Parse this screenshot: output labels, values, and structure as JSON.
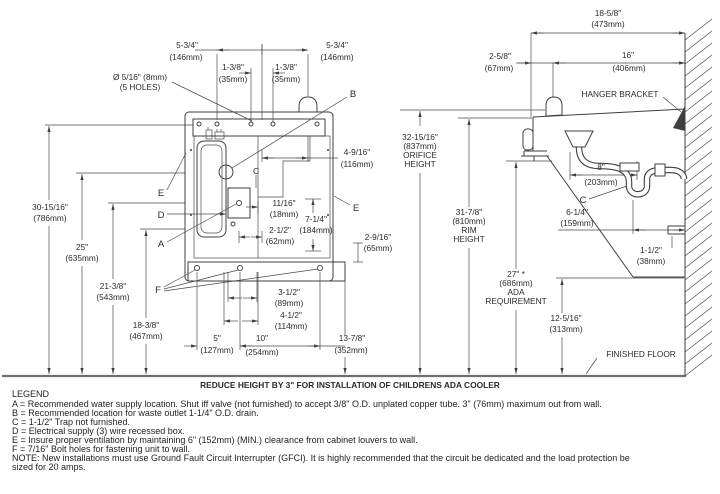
{
  "drawing": {
    "front": {
      "callout_a": "A",
      "callout_b": "B",
      "callout_d": "D",
      "callout_e_left": "E",
      "callout_e_right": "E",
      "callout_f": "F",
      "centerline": "C",
      "holes_note_1": "Ø 5/16\" (8mm)",
      "holes_note_2": "(5 HOLES)",
      "dims": {
        "w146L_in": "5-3/4\"",
        "w146L_mm": "(146mm)",
        "w146R_in": "5-3/4\"",
        "w146R_mm": "(146mm)",
        "w35L_in": "1-3/8\"",
        "w35L_mm": "(35mm)",
        "w35R_in": "1-3/8\"",
        "w35R_mm": "(35mm)",
        "w116_in": "4-9/16\"",
        "w116_mm": "(116mm)",
        "w18_in": "11/16\"",
        "w18_mm": "(18mm)",
        "h184_in": "7-1/4\"",
        "h184_mm": "(184mm)",
        "w62_in": "2-1/2\"",
        "w62_mm": "(62mm)",
        "h65_in": "2-9/16\"",
        "h65_mm": "(65mm)",
        "w89_in": "3-1/2\"",
        "w89_mm": "(89mm)",
        "w114_in": "4-1/2\"",
        "w114_mm": "(114mm)",
        "w127_in": "5\"",
        "w127_mm": "(127mm)",
        "w254_in": "10\"",
        "w254_mm": "(254mm)",
        "w352_in": "13-7/8\"",
        "w352_mm": "(352mm)"
      },
      "heights": {
        "h786_in": "30-15/16\"",
        "h786_mm": "(786mm)",
        "h635_in": "25\"",
        "h635_mm": "(635mm)",
        "h543_in": "21-3/8\"",
        "h543_mm": "(543mm)",
        "h467_in": "18-3/8\"",
        "h467_mm": "(467mm)"
      }
    },
    "mid": {
      "orifice_in": "32-15/16\"",
      "orifice_mm": "(837mm)",
      "orifice_l3": "ORIFICE",
      "orifice_l4": "HEIGHT",
      "rim_in": "31-7/8\"",
      "rim_mm": "(810mm)",
      "rim_l3": "RIM",
      "rim_l4": "HEIGHT",
      "ada_in": "27\" *",
      "ada_mm": "(686mm)",
      "ada_l3": "ADA",
      "ada_l4": "REQUIREMENT",
      "h313_in": "12-5/16\"",
      "h313_mm": "(313mm)"
    },
    "side": {
      "hanger": "HANGER BRACKET",
      "floor": "FINISHED FLOOR",
      "callout_c": "C",
      "d473_in": "18-5/8\"",
      "d473_mm": "(473mm)",
      "d406_in": "16\"",
      "d406_mm": "(406mm)",
      "d67_in": "2-5/8\"",
      "d67_mm": "(67mm)",
      "d203_in": "8\"",
      "d203_mm": "(203mm)",
      "d159_in": "6-1/4\"",
      "d159_mm": "(159mm)",
      "d38_in": "1-1/2\"",
      "d38_mm": "(38mm)"
    }
  },
  "footer": {
    "reduce_note": "REDUCE HEIGHT BY 3\" FOR INSTALLATION OF CHILDRENS ADA COOLER",
    "legend_title": "LEGEND",
    "legend": [
      "A = Recommended water supply location. Shut iff valve (not furnished) to accept 3/8\" O.D. unplated copper tube. 3\" (76mm) maximum out from wall.",
      "B = Recommended location for waste outlet 1-1/4\" O.D. drain.",
      "C = 1-1/2\" Trap not furnished.",
      "D = Electrical supply (3) wire recessed box.",
      "E = Insure proper ventilation by maintaining 6\" (152mm) (MIN.) clearance from cabinet louvers to wall.",
      "F = 7/16\" Bolt holes for fastening unit to wall."
    ],
    "note1": "NOTE: New installations must use Ground Fault Circuit Interrupter (GFCI). It is highly recommended that the circuit be dedicated and the load protection be",
    "note2": "sized for 20 amps."
  }
}
